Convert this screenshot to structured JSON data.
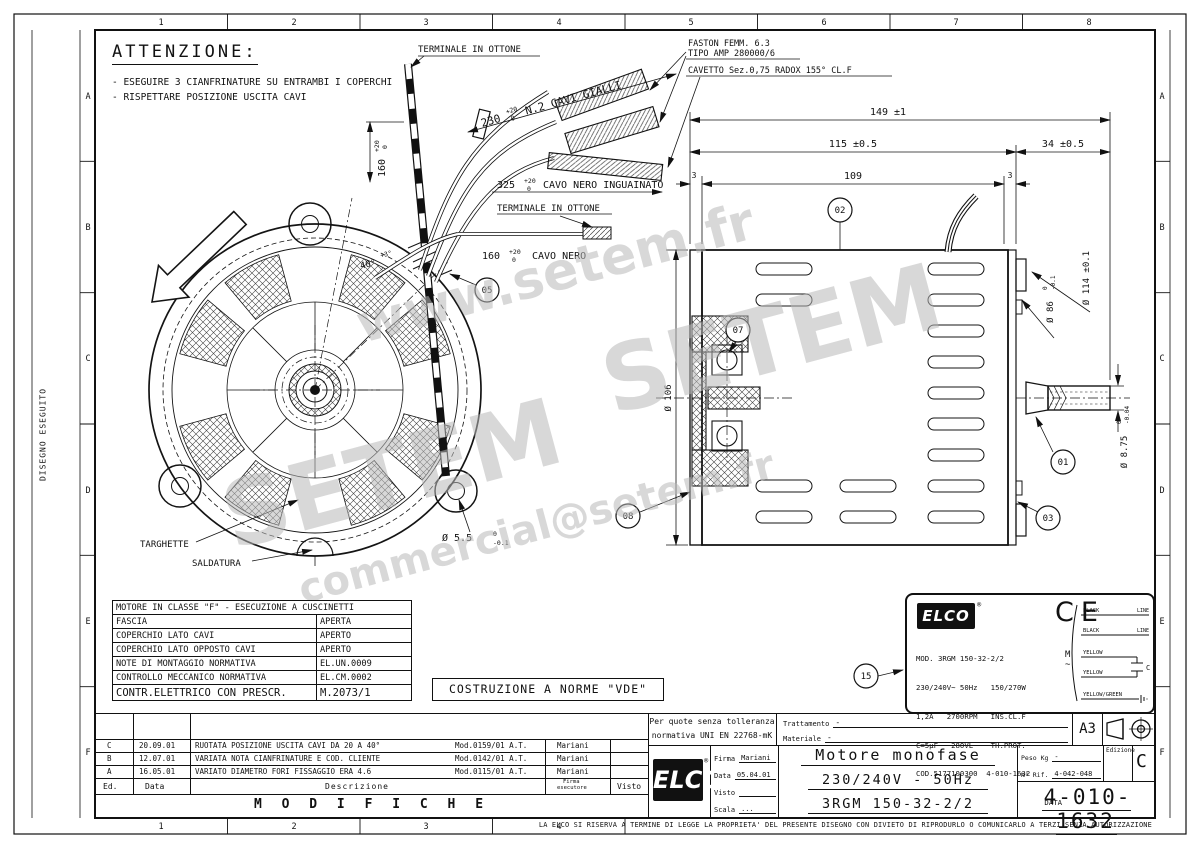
{
  "frame": {
    "top_numbers": [
      "1",
      "2",
      "3",
      "4",
      "5",
      "6",
      "7",
      "8"
    ],
    "bottom_numbers": [
      "1",
      "2",
      "3",
      "4"
    ],
    "side_letters": [
      "A",
      "B",
      "C",
      "D",
      "E",
      "F"
    ],
    "side_label": "DISEGNO ESEGUITO"
  },
  "watermark": {
    "www": "www.setem.fr",
    "brand": "SETEM",
    "email": "commercial@setem.fr"
  },
  "attenzione": {
    "title": "ATTENZIONE:",
    "note1": "- ESEGUIRE 3 CIANFRINATURE SU ENTRAMBI I COPERCHI",
    "note2": "- RISPETTARE POSIZIONE USCITA CAVI"
  },
  "labels": {
    "terminale1": "TERMINALE IN OTTONE",
    "terminale2": "TERMINALE IN OTTONE",
    "faston1": "FASTON FEMM. 6.3",
    "faston2": "TIPO AMP 280000/6",
    "cavetto": "CAVETTO Sez.0,75 RADOX 155° CL.F",
    "targhette": "TARGHETTE",
    "saldatura": "SALDATURA",
    "vde": "COSTRUZIONE A NORME \"VDE\""
  },
  "dims": {
    "d149": "149 ±1",
    "d115": "115 ±0.5",
    "d34": "34 ±0.5",
    "d109": "109",
    "d3l": "3",
    "d3r": "3",
    "d106": "Ø 106",
    "d114": "Ø 114 ±0.1",
    "d86": {
      "v": "Ø 86",
      "up": "0",
      "dn": "-0.1"
    },
    "d875": {
      "v": "Ø 8.75",
      "up": "0",
      "dn": "-0.04"
    },
    "d55": {
      "v": "Ø 5.5",
      "up": "0",
      "dn": "-0.1"
    },
    "d40": {
      "v": "40°",
      "up": "+3°"
    },
    "d160": {
      "v": "160",
      "up": "+20",
      "dn": "0"
    },
    "d230": {
      "v": "230",
      "up": "+20",
      "dn": "0",
      "rest": "N.2 CAVI GIALLI"
    },
    "d325": {
      "v": "325",
      "up": "+20",
      "dn": "0",
      "rest": "CAVO NERO INGUAINATO"
    },
    "d160b": {
      "v": "160",
      "up": "+20",
      "dn": "0",
      "rest": "CAVO NERO"
    }
  },
  "balloons": {
    "b01": "01",
    "b02": "02",
    "b03": "03",
    "b05": "05",
    "b07": "07",
    "b08": "08",
    "b15": "15"
  },
  "class_table": {
    "header": "MOTORE IN CLASSE \"F\" - ESECUZIONE A CUSCINETTI",
    "rows": [
      [
        "FASCIA",
        "APERTA"
      ],
      [
        "COPERCHIO LATO CAVI",
        "APERTO"
      ],
      [
        "COPERCHIO LATO OPPOSTO CAVI",
        "APERTO"
      ],
      [
        "NOTE DI MONTAGGIO NORMATIVA",
        "EL.UN.0009"
      ],
      [
        "CONTROLLO MECCANICO NORMATIVA",
        "EL.CM.0002"
      ],
      [
        "CONTR.ELETTRICO CON PRESCR.",
        "M.2073/1"
      ]
    ]
  },
  "nameplate": {
    "brand": "ELCO",
    "reg": "®",
    "ce": "CE",
    "l1": "MOD. 3RGM 150-32-2/2",
    "l2": "230/240V~ 50Hz   150/270W",
    "l3": "1,2A   2700RPM   INS.CL.F",
    "l4": "C=5µF   280VL    TH.PROT.",
    "l5": "COD.5177100300  4-010-1632",
    "l6": "DATA",
    "wiring": {
      "w1": "BLACK",
      "w1d": "LINE",
      "w2": "BLACK",
      "w2d": "LINE",
      "w3": "YELLOW",
      "w4": "YELLOW",
      "w5": "YELLOW/GREEN",
      "m": "M",
      "tilde": "~",
      "cap": "C"
    }
  },
  "tolerance_box": {
    "l1": "Per quote senza tolleranza",
    "l2": "normativa UNI EN 22768-mK"
  },
  "fields": {
    "trattamento_label": "Trattamento",
    "trattamento": "-",
    "materiale_label": "Materiale",
    "materiale": "-",
    "format": "A3"
  },
  "revisions": {
    "title": "M O D I F I C H E",
    "head": {
      "ed": "Ed.",
      "data": "Data",
      "desc": "Descrizione",
      "firma1": "Firma",
      "firma2": "esecutore",
      "visto": "Visto"
    },
    "rows": [
      {
        "ed": "C",
        "date": "20.09.01",
        "desc": "RUOTATA POSIZIONE USCITA CAVI DA 20 A 40°",
        "mod": "Mod.0159/01 A.T.",
        "firma": "Mariani"
      },
      {
        "ed": "B",
        "date": "12.07.01",
        "desc": "VARIATA NOTA CIANFRINATURE E COD. CLIENTE",
        "mod": "Mod.0142/01 A.T.",
        "firma": "Mariani"
      },
      {
        "ed": "A",
        "date": "16.05.01",
        "desc": "VARIATO DIAMETRO FORI FISSAGGIO ERA 4.6",
        "mod": "Mod.0115/01 A.T.",
        "firma": "Mariani"
      }
    ]
  },
  "titleblock": {
    "brand": "ELCO",
    "reg": "®",
    "firma_label": "Firma",
    "firma": "Mariani",
    "data_label": "Data",
    "data": "05.04.01",
    "visto_label": "Visto",
    "visto": "",
    "scala_label": "Scala",
    "scala": "...",
    "title1": "Motore monofase",
    "title2": "230/240V  -  50Hz",
    "title3": "3RGM 150-32-2/2",
    "peso_label": "Peso Kg",
    "peso": "-",
    "rif_label": "N° Rif.",
    "rif": "4-042-048",
    "edizione_label": "Edizione",
    "edizione": "C",
    "number": "4-010-1632",
    "legal": "LA ELCO SI RISERVA A TERMINE DI LEGGE LA PROPRIETA' DEL PRESENTE DISEGNO CON DIVIETO DI RIPRODURLO O COMUNICARLO A TERZI SENZA AUTORIZZAZIONE"
  }
}
